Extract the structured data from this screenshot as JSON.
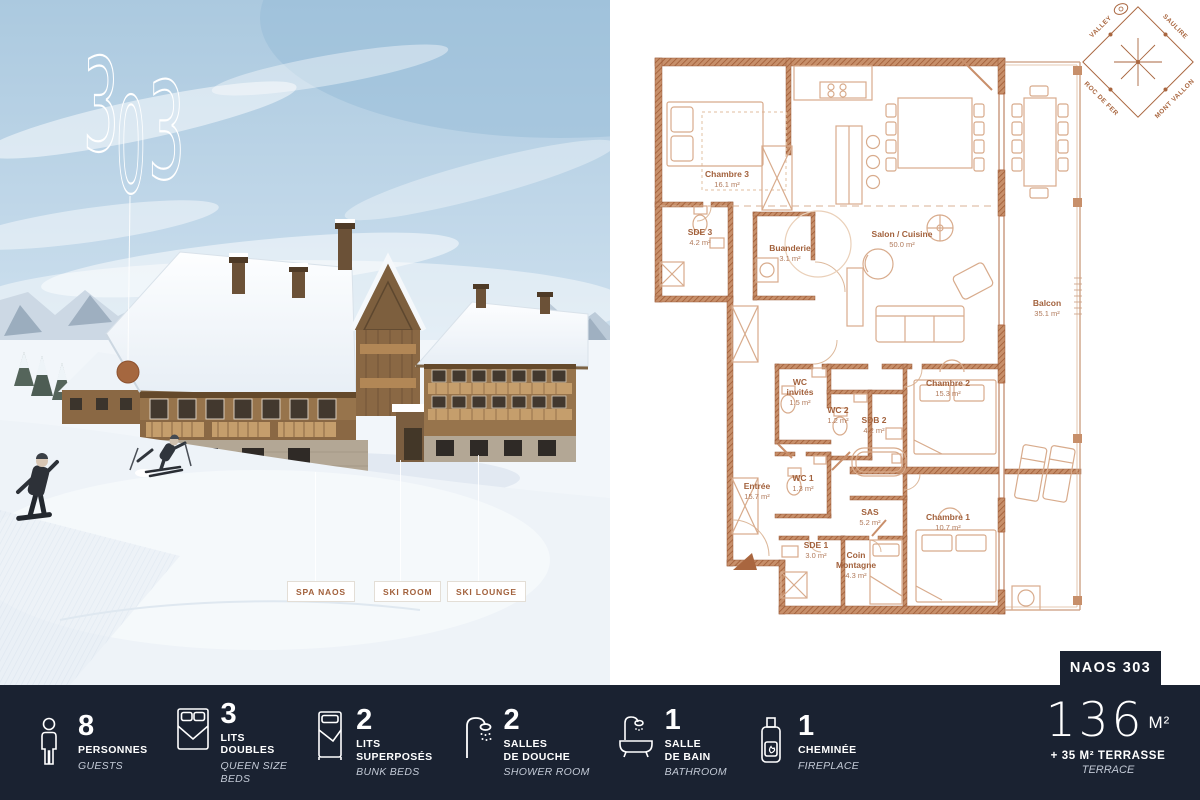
{
  "unit": {
    "logo_digits": [
      "3",
      "0",
      "3"
    ],
    "badge": "NAOS 303",
    "area_value": "136",
    "area_unit": "M²",
    "terrace_fr": "+ 35 M² TERRASSE",
    "terrace_en": "TERRACE"
  },
  "photo": {
    "tags": [
      {
        "label": "SPA NAOS"
      },
      {
        "label": "SKI ROOM"
      },
      {
        "label": "SKI LOUNGE"
      }
    ]
  },
  "compass": {
    "edges": [
      "VALLEY",
      "SAULIRE",
      "ROC DE FER",
      "MONT VALLON"
    ]
  },
  "plan": {
    "rooms": [
      {
        "name": "Chambre 3",
        "area": "16.1 m²"
      },
      {
        "name": "SDE 3",
        "area": "4.2 m²"
      },
      {
        "name": "Buanderie",
        "area": "3.1 m²"
      },
      {
        "name": "Salon / Cuisine",
        "area": "50.0 m²"
      },
      {
        "name": "Balcon",
        "area": "35.1 m²"
      },
      {
        "name": "WC invités",
        "area": "1.5 m²"
      },
      {
        "name": "WC 2",
        "area": "1.2 m²"
      },
      {
        "name": "SDB 2",
        "area": "4.2 m²"
      },
      {
        "name": "Chambre 2",
        "area": "15.3 m²"
      },
      {
        "name": "Entrée",
        "area": "15.7 m²"
      },
      {
        "name": "WC 1",
        "area": "1.3 m²"
      },
      {
        "name": "SAS",
        "area": "5.2 m²"
      },
      {
        "name": "SDE 1",
        "area": "3.0 m²"
      },
      {
        "name": "Coin Montagne",
        "area": "4.3 m²"
      },
      {
        "name": "Chambre 1",
        "area": "10.7 m²"
      }
    ]
  },
  "stats": [
    {
      "value": "8",
      "label": "PERSONNES",
      "sublabel": "GUESTS",
      "icon": "person-icon"
    },
    {
      "value": "3",
      "label": "LITS\nDOUBLES",
      "sublabel": "QUEEN SIZE\nBEDS",
      "icon": "double-bed-icon"
    },
    {
      "value": "2",
      "label": "LITS\nSUPERPOSÉS",
      "sublabel": "BUNK BEDS",
      "icon": "bunk-bed-icon"
    },
    {
      "value": "2",
      "label": "SALLES\nDE DOUCHE",
      "sublabel": "SHOWER ROOM",
      "icon": "shower-icon"
    },
    {
      "value": "1",
      "label": "SALLE\nDE BAIN",
      "sublabel": "BATHROOM",
      "icon": "bathtub-icon"
    },
    {
      "value": "1",
      "label": "CHEMINÉE",
      "sublabel": "FIREPLACE",
      "icon": "fireplace-icon"
    }
  ],
  "colors": {
    "accent": "#a9663f",
    "bar_bg": "#1a2231",
    "plan_wall": "#b5714a"
  }
}
